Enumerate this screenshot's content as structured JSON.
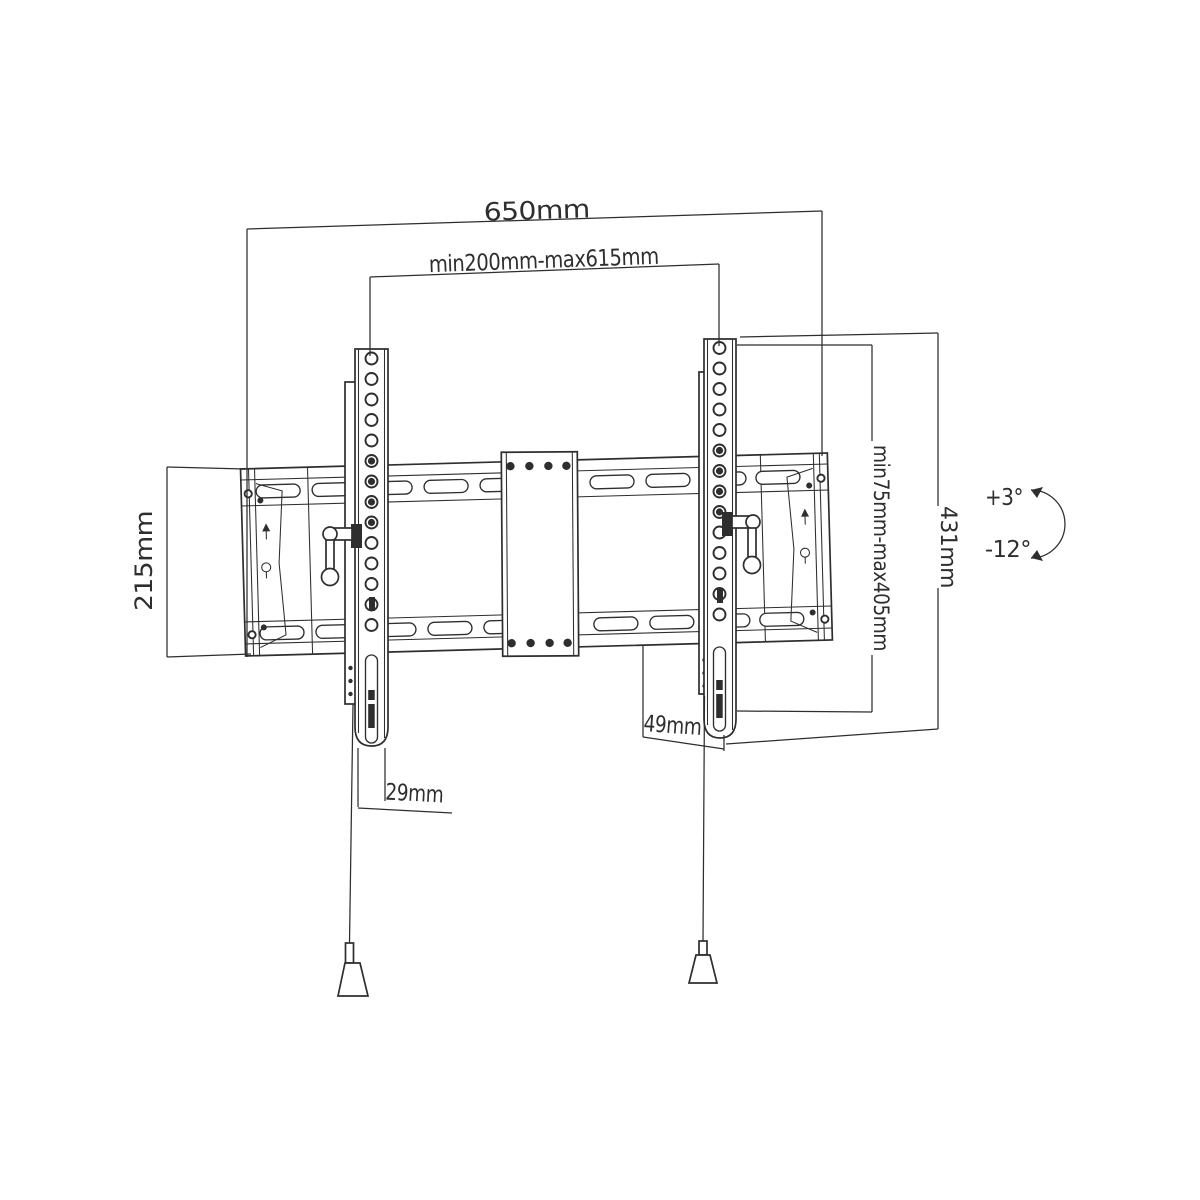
{
  "drawing": {
    "type": "technical-dimension-diagram",
    "subject": "Tilting TV wall mount bracket",
    "line_color": "#2e2e2e",
    "background": "#ffffff",
    "dimensions": {
      "total_width": "650mm",
      "vesa_width_range": "min200mm-max615mm",
      "wall_plate_height": "215mm",
      "bracket_height": "431mm",
      "vesa_height_range": "min75mm-max405mm",
      "bottom_clearance": "49mm",
      "bracket_bottom_depth": "29mm",
      "tilt_up": "+3°",
      "tilt_down": "-12°"
    }
  }
}
